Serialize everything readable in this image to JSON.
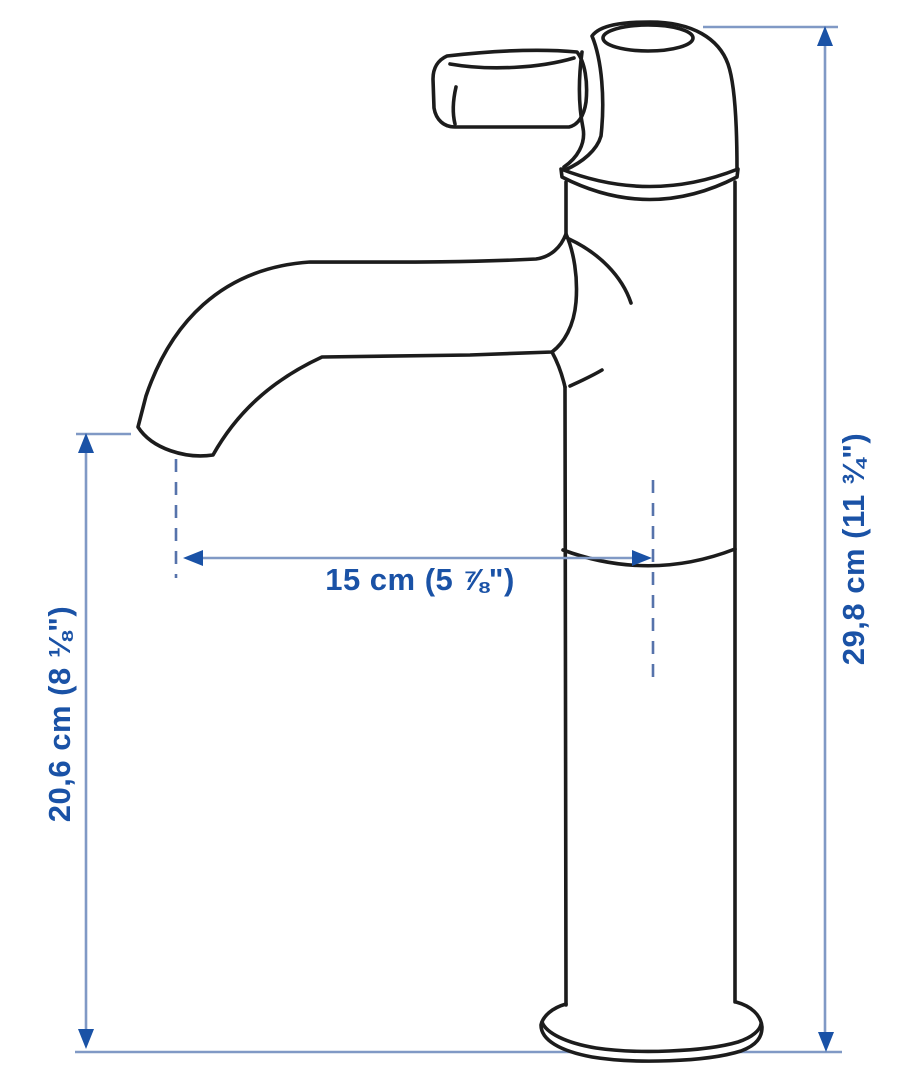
{
  "diagram": {
    "labels": {
      "spout_reach": "15 cm (5 ⅞\")",
      "total_height": "29,8 cm (11 ¾\")",
      "spout_height": "20,6 cm (8 ⅛\")"
    }
  },
  "colors": {
    "background": "#ffffff",
    "outline": "#1c1c1c",
    "fill": "#ffffff",
    "dim_line": "#8099c5",
    "dim_dash": "#5673ab",
    "accent": "#1a52a6"
  }
}
